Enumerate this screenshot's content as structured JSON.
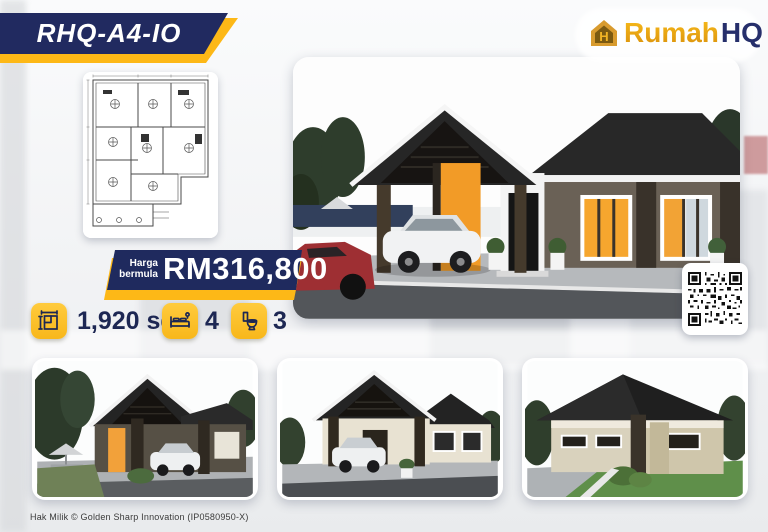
{
  "badge": {
    "model": "RHQ-A4-IO"
  },
  "logo": {
    "brand_primary": "Rumah",
    "brand_secondary": "HQ",
    "icon": "house-monogram-icon"
  },
  "price": {
    "label_line1": "Harga",
    "label_line2": "bermula",
    "amount": "RM316,800"
  },
  "specs": [
    {
      "icon": "floor-area-icon",
      "value": "1,920 sqf"
    },
    {
      "icon": "bed-icon",
      "value": "4"
    },
    {
      "icon": "toilet-icon",
      "value": "3"
    }
  ],
  "images": {
    "floor_plan": "floor-plan-line-drawing",
    "main": "main-house-3d-render",
    "thumbnails": [
      "house-render-angle-view",
      "house-render-front-view",
      "house-render-rear-view"
    ],
    "qr": "qr-code"
  },
  "footer": {
    "copyright": "Hak Milik © Golden Sharp Innovation (IP0580950-X)"
  },
  "colors": {
    "navy": "#222c5e",
    "yellow": "#fdb817",
    "gold": "#e09c26",
    "icon_yellow": "#ffc42f",
    "text_navy": "#1d2753"
  }
}
